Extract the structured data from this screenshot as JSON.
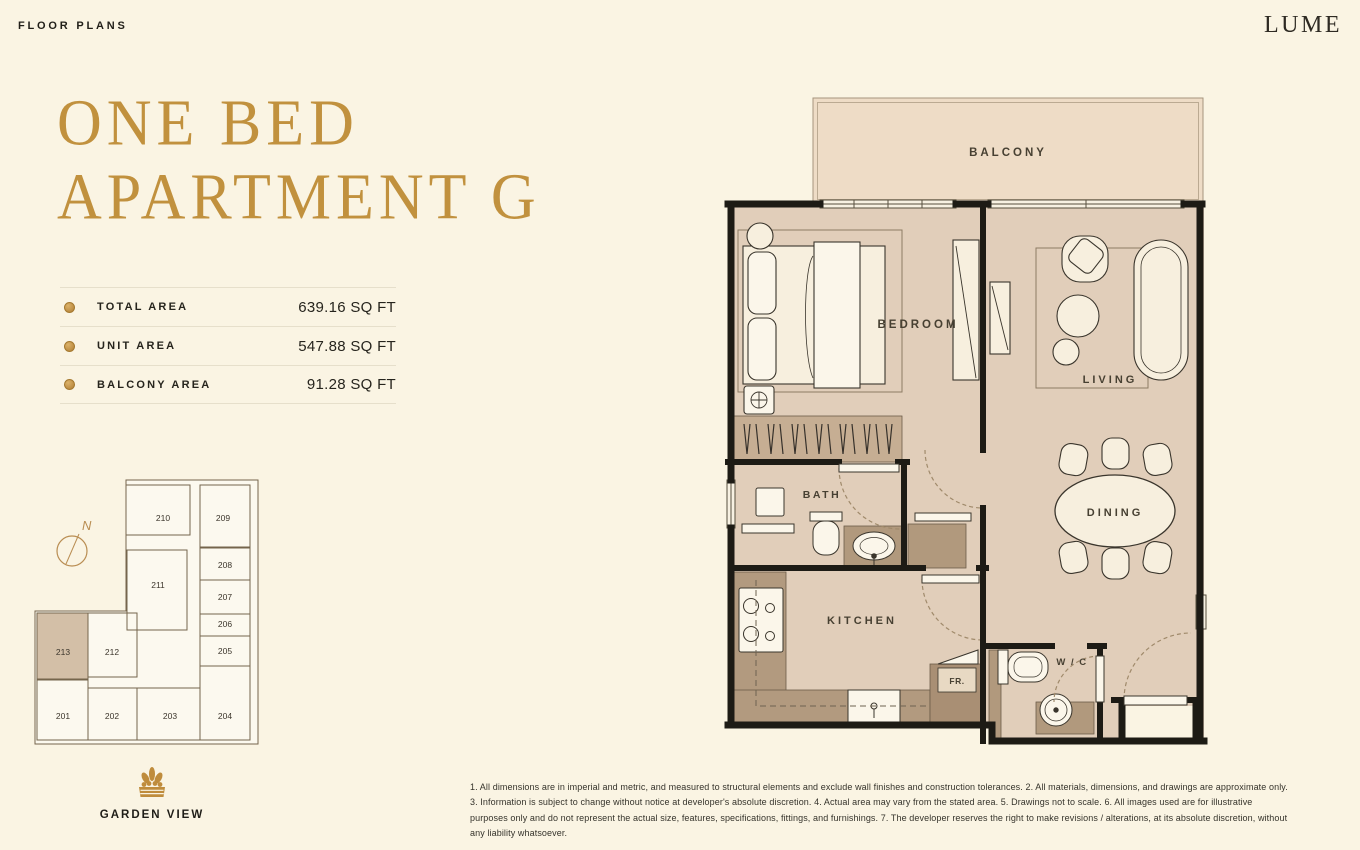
{
  "header": {
    "eyebrow": "FLOOR PLANS",
    "brand": "LUME"
  },
  "title": {
    "line1": "ONE BED",
    "line2": "APARTMENT G"
  },
  "area_table": {
    "rows": [
      {
        "label": "TOTAL AREA",
        "value": "639.16 SQ FT"
      },
      {
        "label": "UNIT AREA",
        "value": "547.88 SQ FT"
      },
      {
        "label": "BALCONY AREA",
        "value": "91.28 SQ FT"
      }
    ]
  },
  "keyplan": {
    "compass": "N",
    "highlighted_unit": "213",
    "units": {
      "201": "201",
      "202": "202",
      "203": "203",
      "204": "204",
      "205": "205",
      "206": "206",
      "207": "207",
      "208": "208",
      "209": "209",
      "210": "210",
      "211": "211",
      "212": "212",
      "213": "213"
    },
    "view_label": "GARDEN VIEW"
  },
  "floorplan": {
    "rooms": {
      "balcony": "BALCONY",
      "bedroom": "BEDROOM",
      "living": "LIVING",
      "bath": "BATH",
      "dining": "DINING",
      "kitchen": "KITCHEN",
      "wc": "W / C",
      "fridge": "FR."
    }
  },
  "disclaimer": "1. All dimensions are in imperial and metric, and measured to structural elements and exclude wall finishes and construction tolerances. 2. All materials, dimensions, and drawings are approximate only. 3. Information is subject to change without notice at developer's absolute discretion. 4. Actual area may vary from the stated area. 5. Drawings not to scale. 6. All images used are for illustrative purposes only and do not represent the actual size, features, specifications, fittings, and furnishings. 7. The developer reserves the right to make revisions / alterations, at its absolute discretion, without any liability whatsoever.",
  "colors": {
    "accent_gold": "#C0903F",
    "title_gold": "#C1913E",
    "wall": "#1D1B15",
    "floor": "#E1CEBA",
    "balcony": "#EEDCC6",
    "counter": "#B29A7F",
    "keyplan_highlight": "#D3BFA7"
  }
}
